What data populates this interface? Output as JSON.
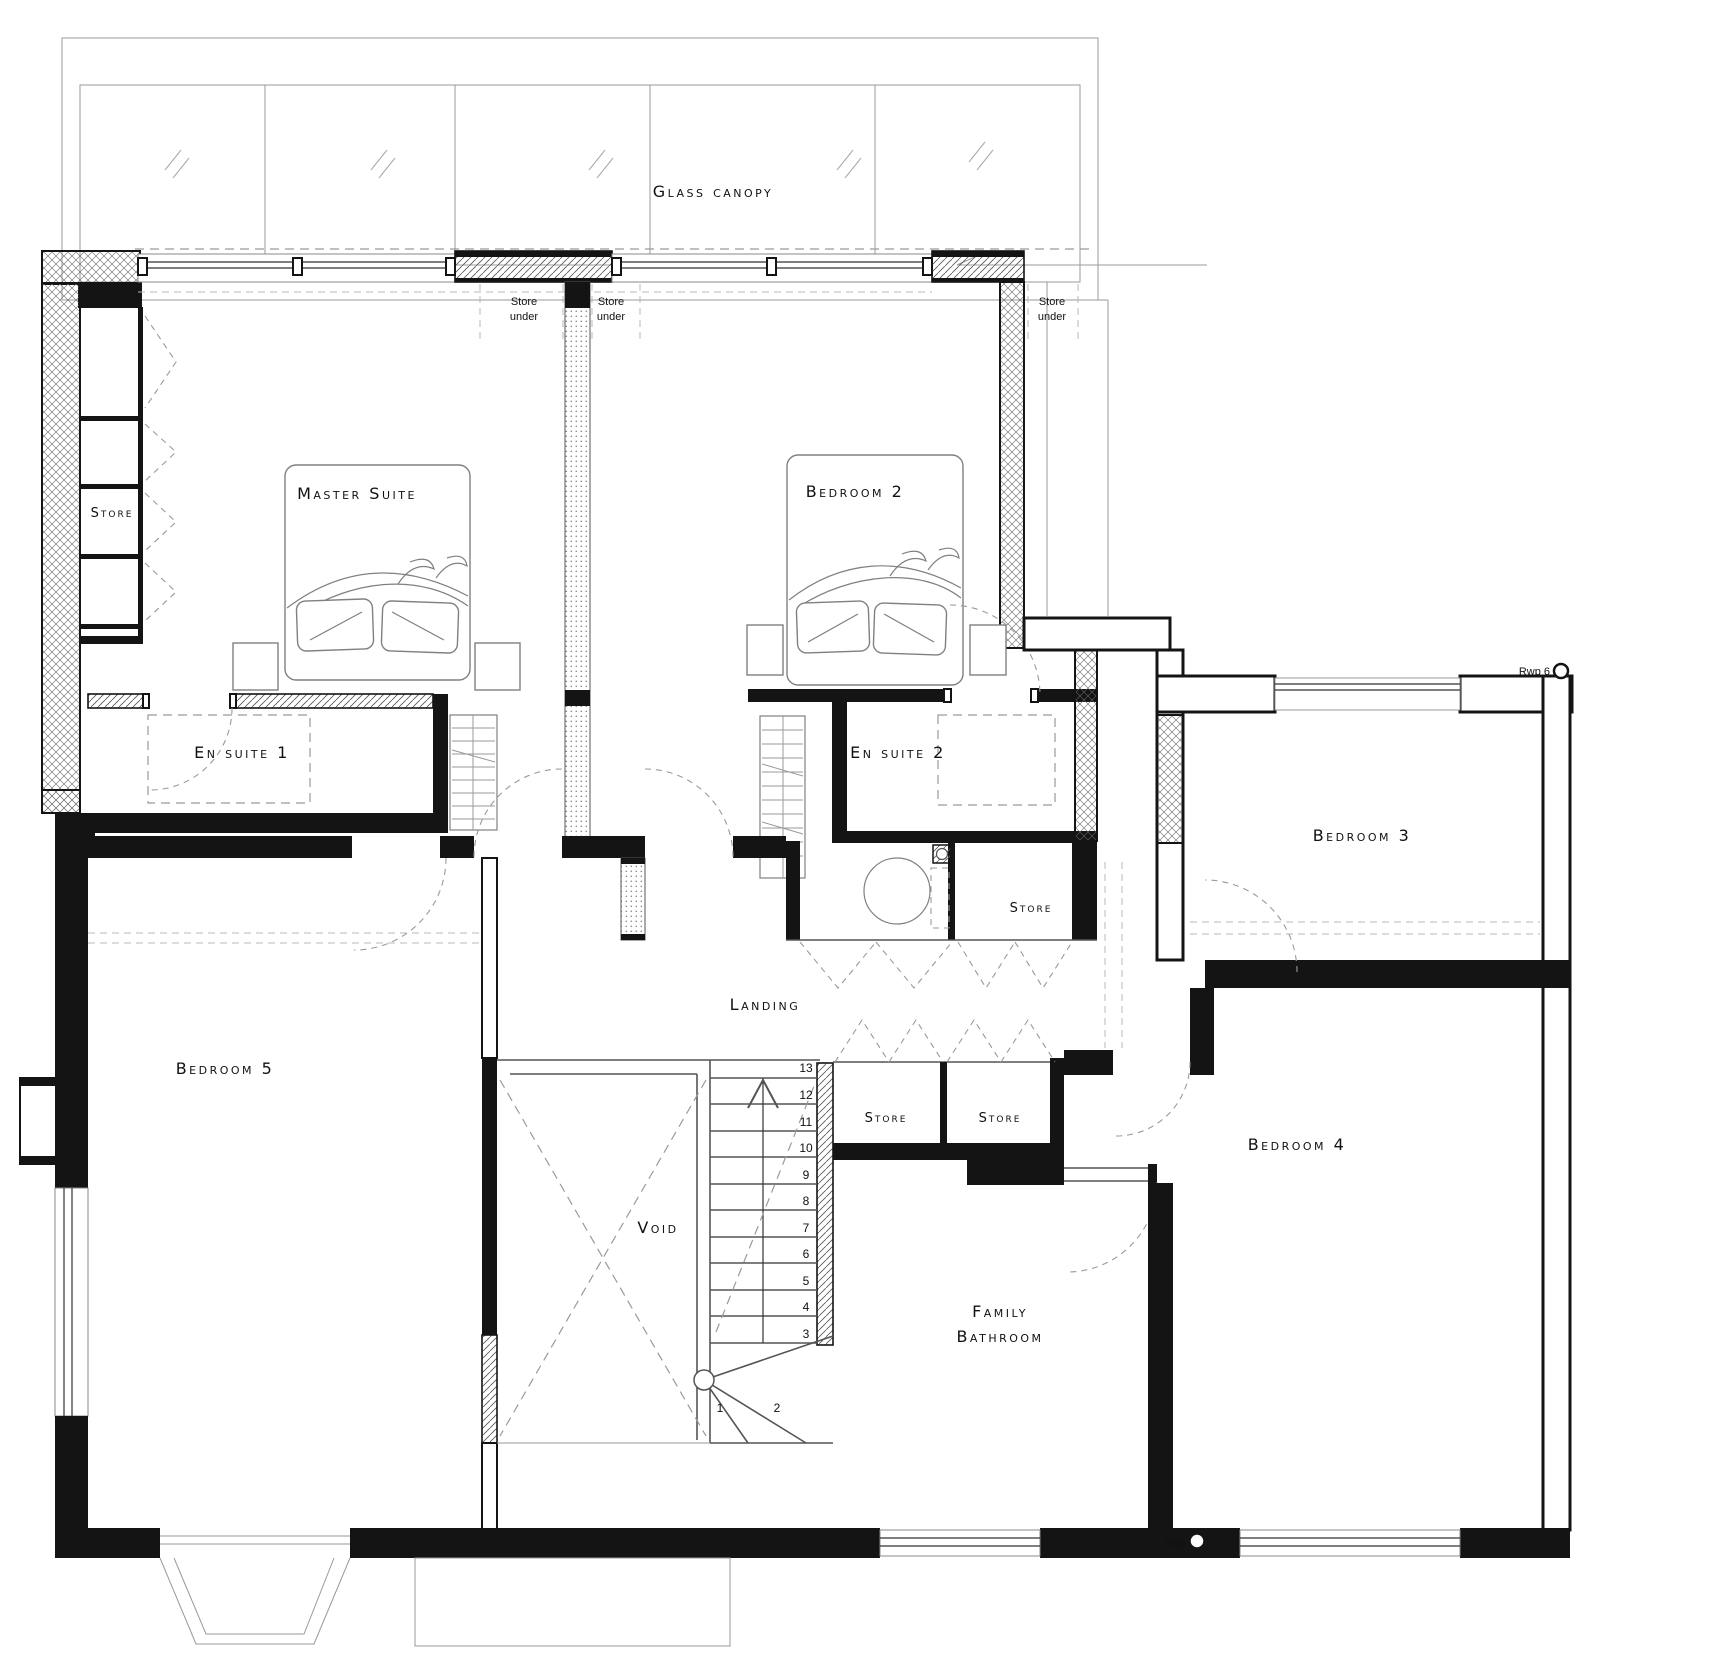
{
  "page": {
    "background": "#ffffff",
    "ink": "#141414"
  },
  "canopy": {
    "label": "Glass canopy"
  },
  "rooms": {
    "master_suite": "Master Suite",
    "bedroom2": "Bedroom 2",
    "bedroom3": "Bedroom 3",
    "bedroom4": "Bedroom 4",
    "bedroom5": "Bedroom 5",
    "en_suite1": "En suite 1",
    "en_suite2": "En suite 2",
    "family_bathroom_line1": "Family",
    "family_bathroom_line2": "Bathroom",
    "landing": "Landing",
    "void": "Void"
  },
  "stores": {
    "wall_store": "Store",
    "cylinder_store": "Store",
    "landing_store_a": "Store",
    "landing_store_b": "Store",
    "store_under_line1": "Store",
    "store_under_line2": "under"
  },
  "stairs": {
    "numbers": [
      "1",
      "2",
      "3",
      "4",
      "5",
      "6",
      "7",
      "8",
      "9",
      "10",
      "11",
      "12",
      "13"
    ]
  },
  "annotations": {
    "rwp6": "Rwp 6",
    "rwp": "Rwp"
  }
}
